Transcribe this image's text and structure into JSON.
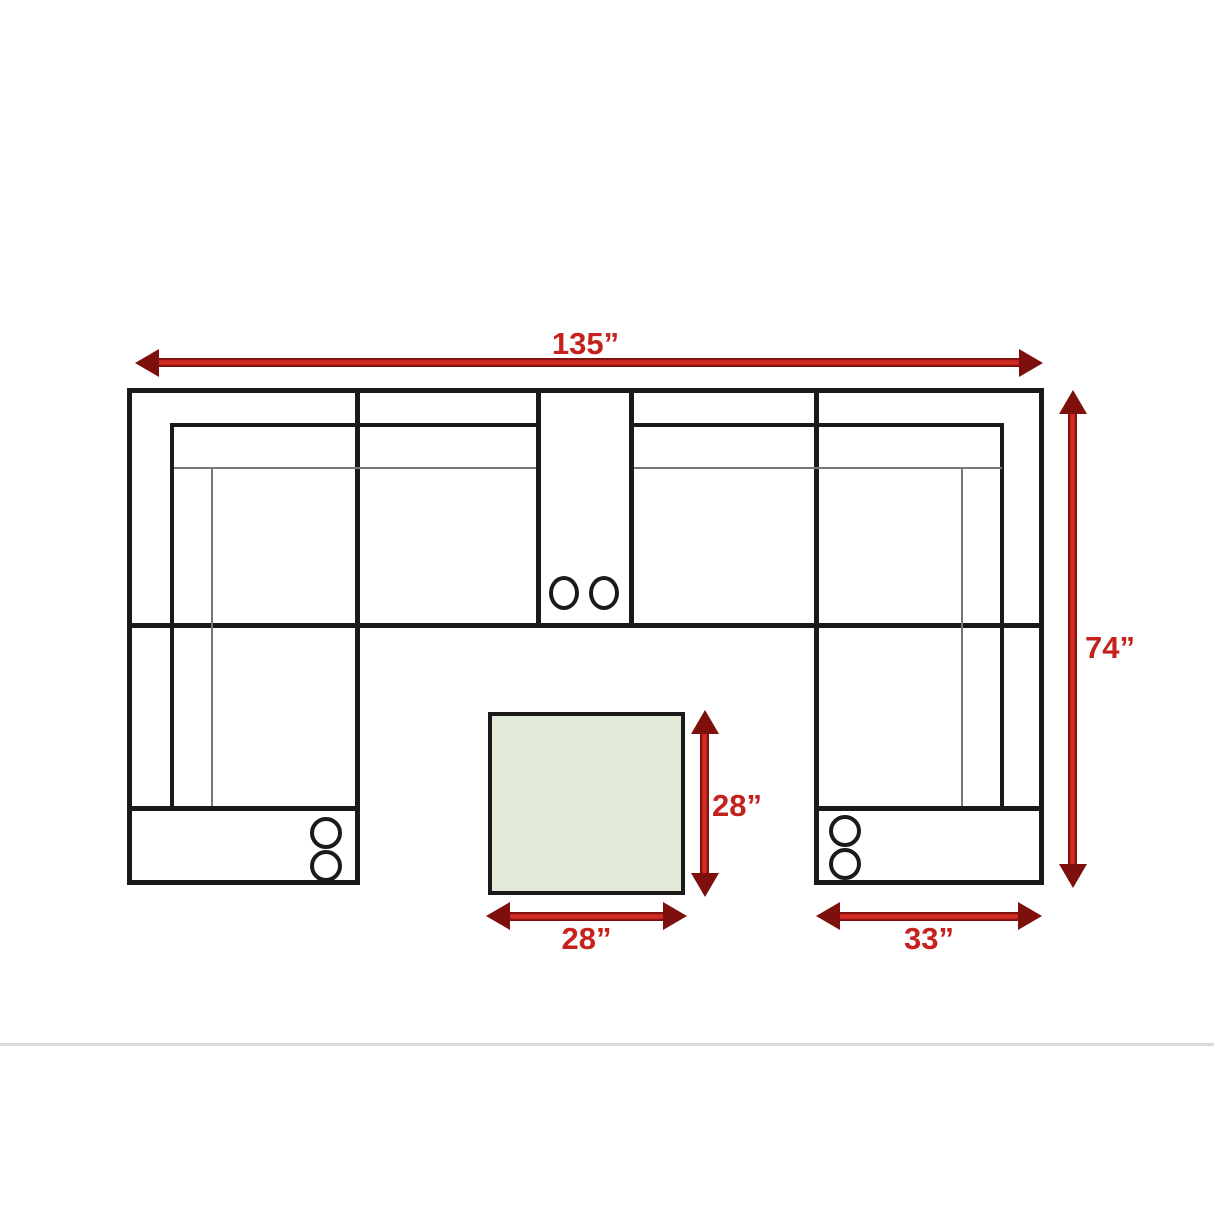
{
  "diagram": {
    "type": "sectional-sofa-floor-plan",
    "labels": {
      "total_width": "135”",
      "total_depth": "74”",
      "ottoman_depth": "28”",
      "ottoman_width": "28”",
      "end_section_width": "33”"
    },
    "colors": {
      "arrow_red": "#c5221e",
      "arrow_red_dark": "#7d100d",
      "line_black": "#1a1a1a",
      "thin_gray": "#777777",
      "ottoman_green": "#e0ead6",
      "separator_gray": "#d9d9d9",
      "background": "#ffffff"
    }
  }
}
